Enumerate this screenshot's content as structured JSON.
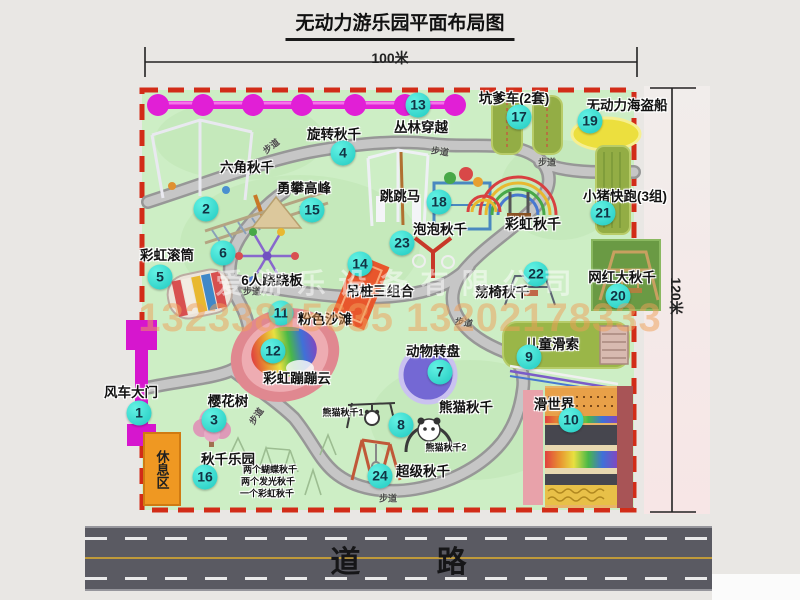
{
  "title": "无动力游乐园平面布局图",
  "dimensions": {
    "top": "100米",
    "right": "120米"
  },
  "road": {
    "label": "道 路"
  },
  "rest_area": {
    "label": "休息区"
  },
  "watermark": {
    "company": "爱游乐设备有限公司",
    "phone": "13233815635 13202178333"
  },
  "path_label_text": "步道",
  "path_labels": [
    {
      "x": 271,
      "y": 146,
      "r": -38
    },
    {
      "x": 440,
      "y": 151,
      "r": 8
    },
    {
      "x": 547,
      "y": 162,
      "r": 0
    },
    {
      "x": 252,
      "y": 291,
      "r": 0
    },
    {
      "x": 464,
      "y": 322,
      "r": 10
    },
    {
      "x": 256,
      "y": 416,
      "r": -55
    },
    {
      "x": 388,
      "y": 498,
      "r": 0
    }
  ],
  "attractions": [
    {
      "num": "1",
      "label": "风车大门",
      "lx": 131,
      "ly": 391,
      "cx": 139,
      "cy": 413
    },
    {
      "num": "2",
      "label": "六角秋千",
      "lx": 247,
      "ly": 166,
      "cx": 206,
      "cy": 209
    },
    {
      "num": "3",
      "label": "樱花树",
      "lx": 228,
      "ly": 400,
      "cx": 214,
      "cy": 420
    },
    {
      "num": "4",
      "label": "旋转秋千",
      "lx": 334,
      "ly": 133,
      "cx": 343,
      "cy": 153
    },
    {
      "num": "5",
      "label": "彩虹滚筒",
      "lx": 167,
      "ly": 254,
      "cx": 160,
      "cy": 277
    },
    {
      "num": "6",
      "label": "6人跷跷板",
      "lx": 272,
      "ly": 279,
      "cx": 223,
      "cy": 253
    },
    {
      "num": "7",
      "label": "动物转盘",
      "lx": 433,
      "ly": 350,
      "cx": 440,
      "cy": 372
    },
    {
      "num": "8",
      "label": "熊猫秋千",
      "lx": 466,
      "ly": 406,
      "cx": 401,
      "cy": 425
    },
    {
      "num": "9",
      "label": "儿童滑索",
      "lx": 552,
      "ly": 343,
      "cx": 529,
      "cy": 357
    },
    {
      "num": "10",
      "label": "滑世界",
      "lx": 554,
      "ly": 403,
      "cx": 571,
      "cy": 420
    },
    {
      "num": "11",
      "label": "粉色沙滩",
      "lx": 325,
      "ly": 318,
      "cx": 281,
      "cy": 313
    },
    {
      "num": "12",
      "label": "彩虹蹦蹦云",
      "lx": 297,
      "ly": 377,
      "cx": 273,
      "cy": 351
    },
    {
      "num": "13",
      "label": "丛林穿越",
      "lx": 421,
      "ly": 126,
      "cx": 418,
      "cy": 105
    },
    {
      "num": "14",
      "label": "吊桩三组合",
      "lx": 380,
      "ly": 290,
      "cx": 360,
      "cy": 264
    },
    {
      "num": "15",
      "label": "勇攀高峰",
      "lx": 304,
      "ly": 187,
      "cx": 312,
      "cy": 210
    },
    {
      "num": "16",
      "label": "秋千乐园",
      "lx": 228,
      "ly": 458,
      "cx": 205,
      "cy": 477
    },
    {
      "num": "17",
      "label": "坑爹车(2套)",
      "lx": 514,
      "ly": 97,
      "cx": 519,
      "cy": 117
    },
    {
      "num": "18",
      "label": "跳跳马",
      "lx": 400,
      "ly": 195,
      "cx": 439,
      "cy": 202
    },
    {
      "num": "19",
      "label": "无动力海盗船",
      "lx": 627,
      "ly": 104,
      "cx": 590,
      "cy": 121
    },
    {
      "num": "20",
      "label": "网红大秋千",
      "lx": 622,
      "ly": 276,
      "cx": 618,
      "cy": 296
    },
    {
      "num": "21",
      "label": "小猪快跑(3组)",
      "lx": 625,
      "ly": 195,
      "cx": 603,
      "cy": 213
    },
    {
      "num": "22",
      "label": "荡椅秋千",
      "lx": 502,
      "ly": 291,
      "cx": 536,
      "cy": 274
    },
    {
      "num": "23",
      "label": "泡泡秋千",
      "lx": 440,
      "ly": 228,
      "cx": 402,
      "cy": 243
    },
    {
      "num": "24",
      "label": "超级秋千",
      "lx": 423,
      "ly": 470,
      "cx": 380,
      "cy": 476
    }
  ],
  "extra_labels": [
    {
      "name": "rainbow-swing-label",
      "text": "彩虹秋千",
      "x": 533,
      "y": 224,
      "size": 14
    },
    {
      "name": "panda-swing-1-label",
      "text": "熊猫秋千1",
      "x": 343,
      "y": 412,
      "size": 9
    },
    {
      "name": "panda-swing-2-label",
      "text": "熊猫秋千2",
      "x": 446,
      "y": 447,
      "size": 9
    },
    {
      "name": "swing-park-item-1",
      "text": "两个蝴蝶秋千",
      "x": 270,
      "y": 469,
      "size": 9
    },
    {
      "name": "swing-park-item-2",
      "text": "两个发光秋千",
      "x": 268,
      "y": 481,
      "size": 9
    },
    {
      "name": "swing-park-item-3",
      "text": "一个彩虹秋千",
      "x": 267,
      "y": 493,
      "size": 9
    }
  ],
  "colors": {
    "park_green": "#cdeec5",
    "border_red": "#d22c18",
    "path_gray": "#c6c6c6",
    "marker_teal": "#1fc9c0",
    "gate_magenta": "#d616ce",
    "rest_orange": "#ef9822",
    "road_gray": "#5a5a62",
    "watermark_orange": "#f0a058"
  }
}
